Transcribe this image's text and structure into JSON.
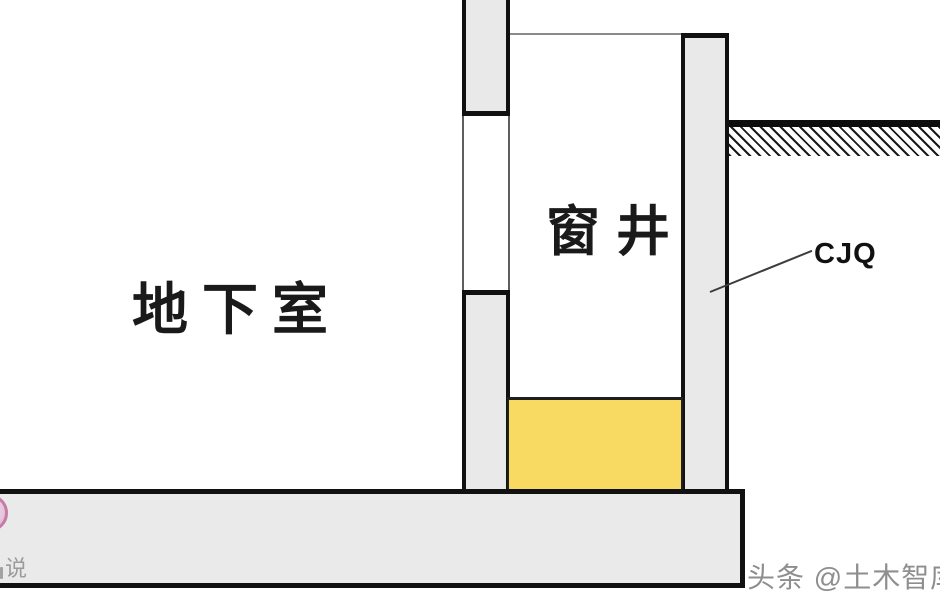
{
  "labels": {
    "basement": "地下室",
    "window_well": "窗井",
    "wall_tag": "CJQ"
  },
  "watermarks": {
    "bottom_right": "头条 @土木智库",
    "bottom_left_partial": "说"
  },
  "colors": {
    "wall_fill": "#e9e9e9",
    "slab_fill": "#eaeaea",
    "outline_black": "#111111",
    "thin_line_gray": "#5f5f5f",
    "well_top_line_gray": "#8a8a8a",
    "sand_fill_yellow": "#f8da63",
    "watermark_gray": "#8e8e8e",
    "logo_pink": "#c77ba6"
  },
  "diagram": {
    "type": "architectural-section",
    "parts": [
      "basement-wall-upper",
      "basement-window-opening",
      "basement-wall-lower",
      "window-well-shaft",
      "window-well-outer-wall-cjq",
      "ground-line-with-hatch",
      "well-bottom-fill",
      "base-slab"
    ]
  }
}
